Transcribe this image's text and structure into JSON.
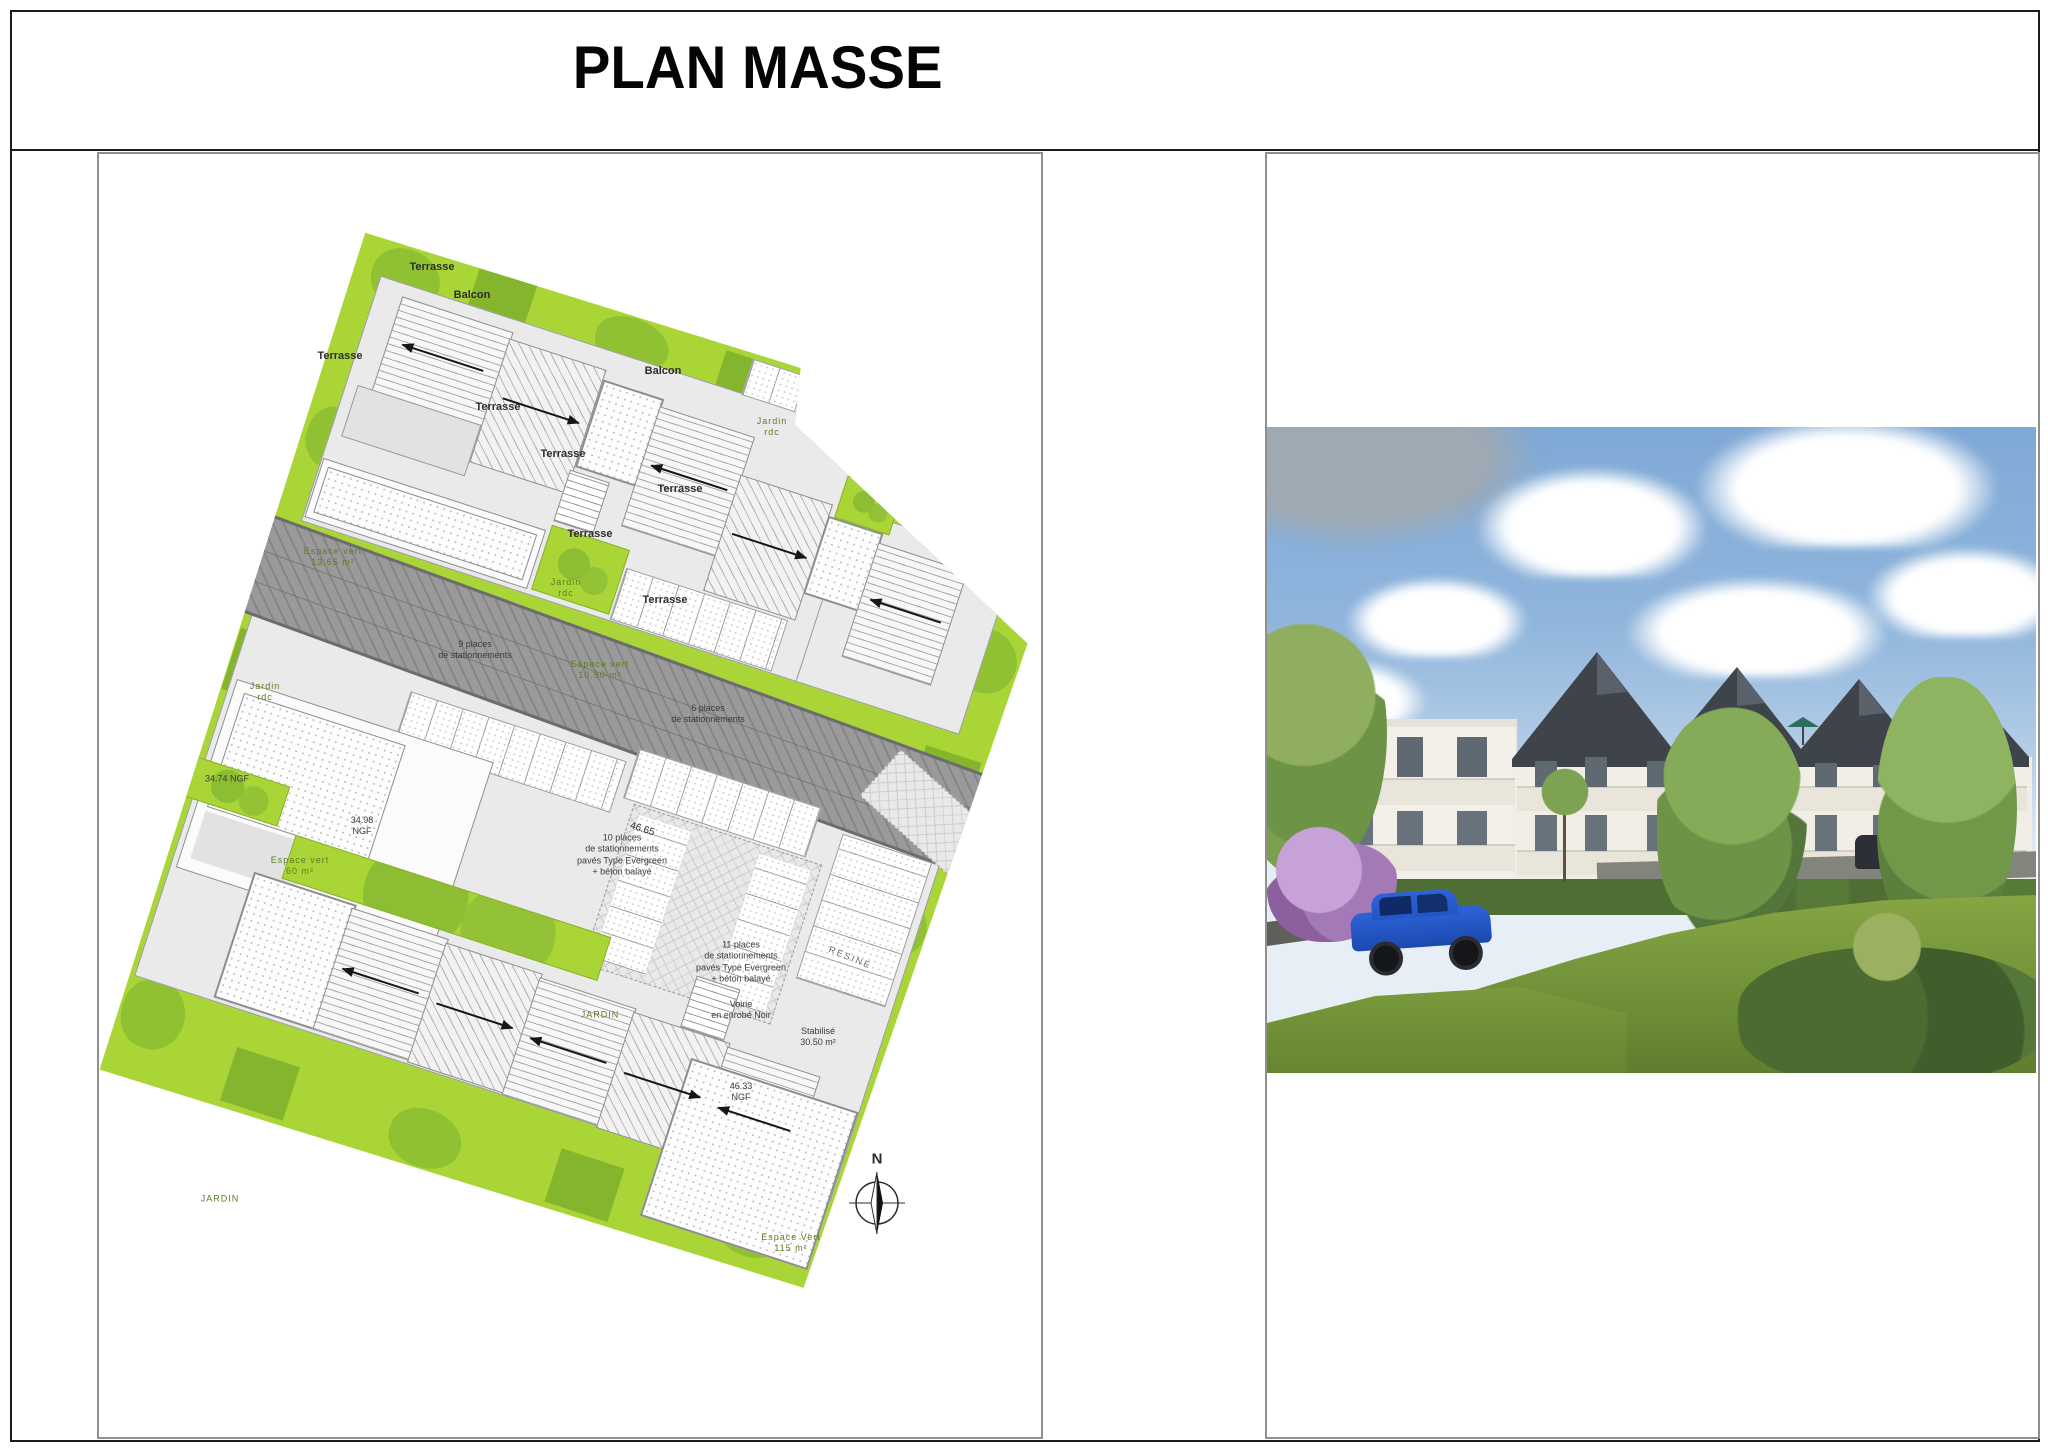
{
  "title": {
    "text": "PLAN MASSE"
  },
  "plan": {
    "labels": {
      "terrasse": "Terrasse",
      "balcon": "Balcon",
      "jardin_rdc": "Jardin\nrdc",
      "jardin": "JARDIN",
      "espace_vert_1365": "Espace vert\n13.65 m²",
      "espace_vert_60": "Espace vert\n60 m²",
      "espace_vert_1050": "Espace vert\n10.50 m²",
      "espace_vert_115": "Espace Vert\n115 m²",
      "parking_9": "9 places\nde stationnements",
      "parking_6": "6 places\nde stationnements",
      "parking_10": "10 places\nde stationnements\npavés Type Evergreen\n+ béton balayé",
      "parking_11": "11 places\nde stationnements\npavés Type Evergreen\n+ béton balayé",
      "voirie": "Voirie\nen enrobé Noir",
      "stabilise": "Stabilisé\n30.50 m²",
      "ngf_34_74": "34.74 NGF",
      "ngf_34_98": "34.98\nNGF",
      "ngf_46_33": "46.33\nNGF",
      "dim_46_65": "46.65",
      "street": "RESINE",
      "north": "N"
    },
    "colors": {
      "landscape_green": "#a9d636",
      "tree_green": "#8cbd33",
      "road_gray": "#9a9a9a",
      "building_fill": "#eaeaea"
    }
  },
  "photo": {
    "colors": {
      "sky": "#7fa9d6",
      "facade": "#f3f0e9",
      "roof": "#3f444b",
      "grass": "#74953a",
      "car_blue": "#1f55c8"
    }
  }
}
